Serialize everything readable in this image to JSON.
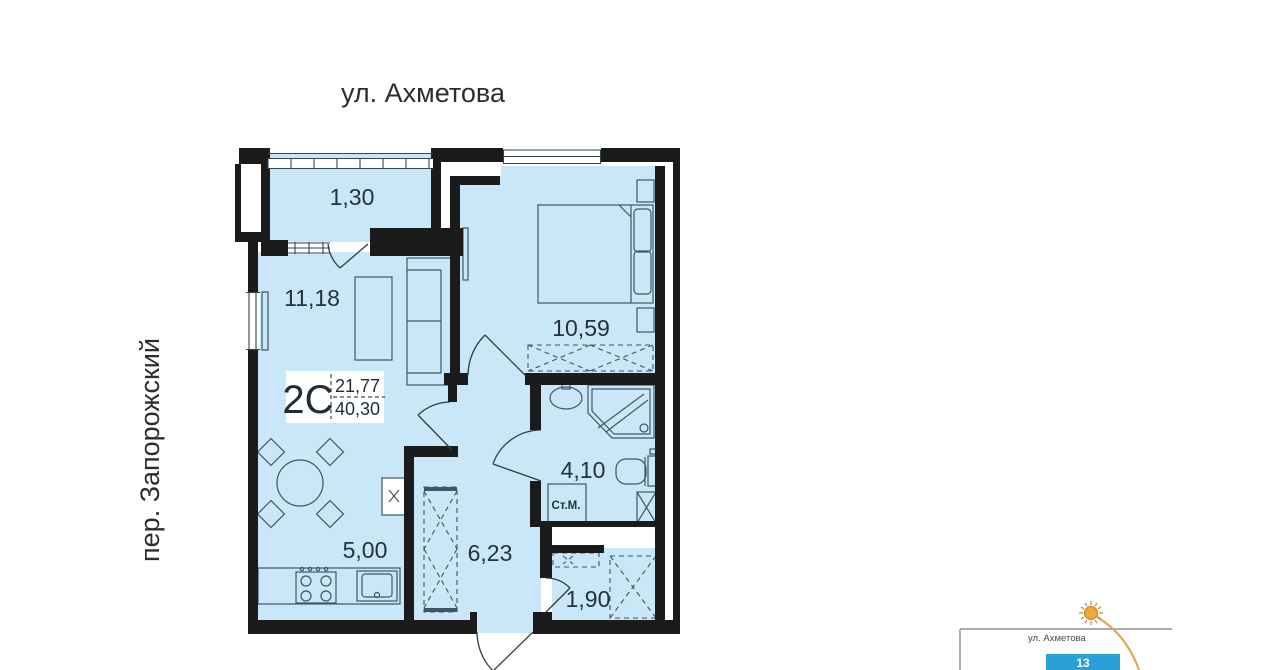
{
  "streets": {
    "top": "ул. Ахметова",
    "left": "пер. Запорожский"
  },
  "apartment": {
    "type_label": "2С",
    "area_upper": "21,77",
    "area_lower": "40,30",
    "rooms": [
      {
        "id": "balcony",
        "area": "1,30"
      },
      {
        "id": "living-room",
        "area": "11,18"
      },
      {
        "id": "bedroom",
        "area": "10,59"
      },
      {
        "id": "bathroom",
        "area": "4,10"
      },
      {
        "id": "kitchen",
        "area": "5,00"
      },
      {
        "id": "hallway",
        "area": "6,23"
      },
      {
        "id": "storage",
        "area": "1,90"
      }
    ],
    "washing_machine_label": "Ст.М."
  },
  "minimap": {
    "street_label": "ул. Ахметова",
    "building_number": "13",
    "building_color": "#2aa0d8",
    "sun_color": "#efa73e"
  },
  "colors": {
    "floor_fill": "#c9e7f8",
    "wall": "#1b1b1b",
    "furniture_line": "#3f5666"
  }
}
